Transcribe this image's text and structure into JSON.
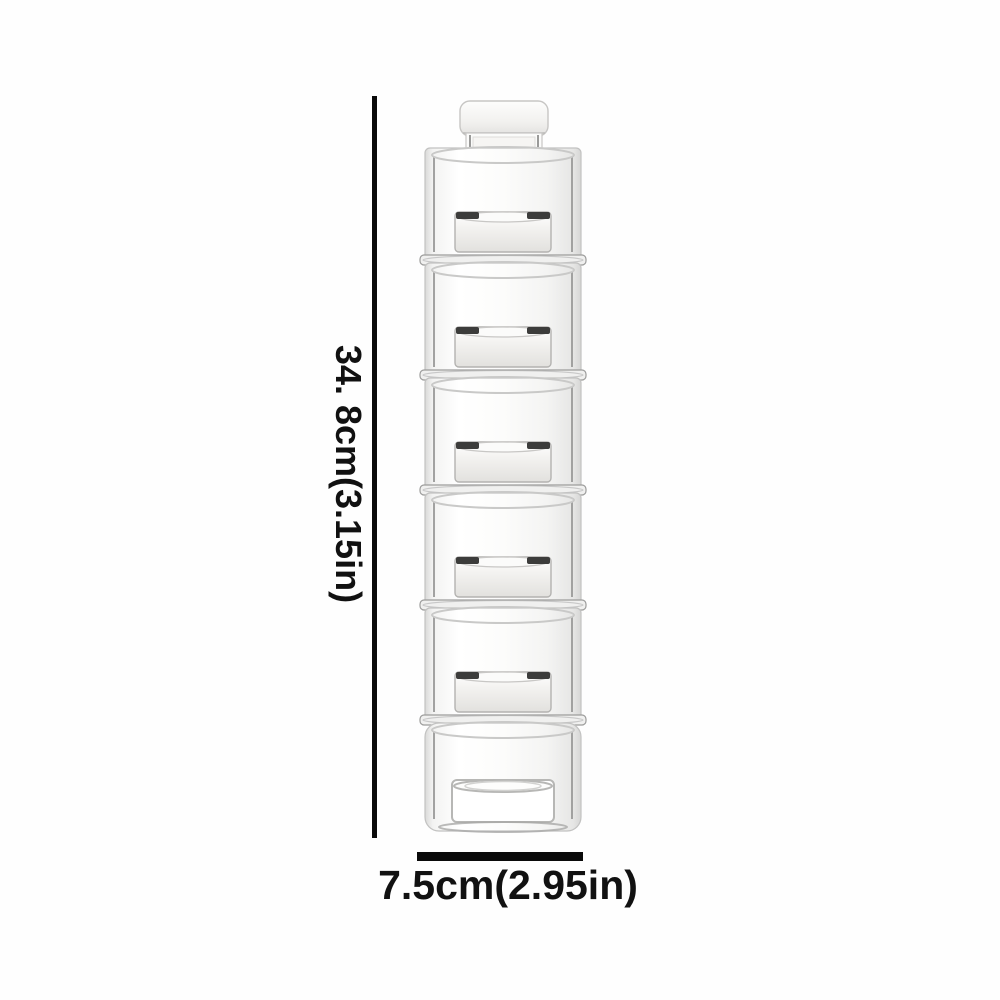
{
  "image": {
    "background": "#fefefe",
    "subject": "six-tier stackable clear spice jar tower with white top cap"
  },
  "product": {
    "tier_count": 6,
    "colors": {
      "glass_edge": "#9a9a99",
      "glass_outline": "#c2c2c1",
      "opening_line": "#c9c9c8",
      "rim_fill": "#f0f0ef",
      "rim_edge": "#9c9c9b",
      "lid_outline": "#b3b2b0",
      "accent_dark": "#3c3c3b",
      "cap_outline": "#c7c6c4"
    }
  },
  "dimensions": {
    "height_label": "34. 8cm(3.15in)",
    "width_label": "7.5cm(2.95in)",
    "line_color": "#0a0a0a",
    "text_color": "#111111"
  }
}
